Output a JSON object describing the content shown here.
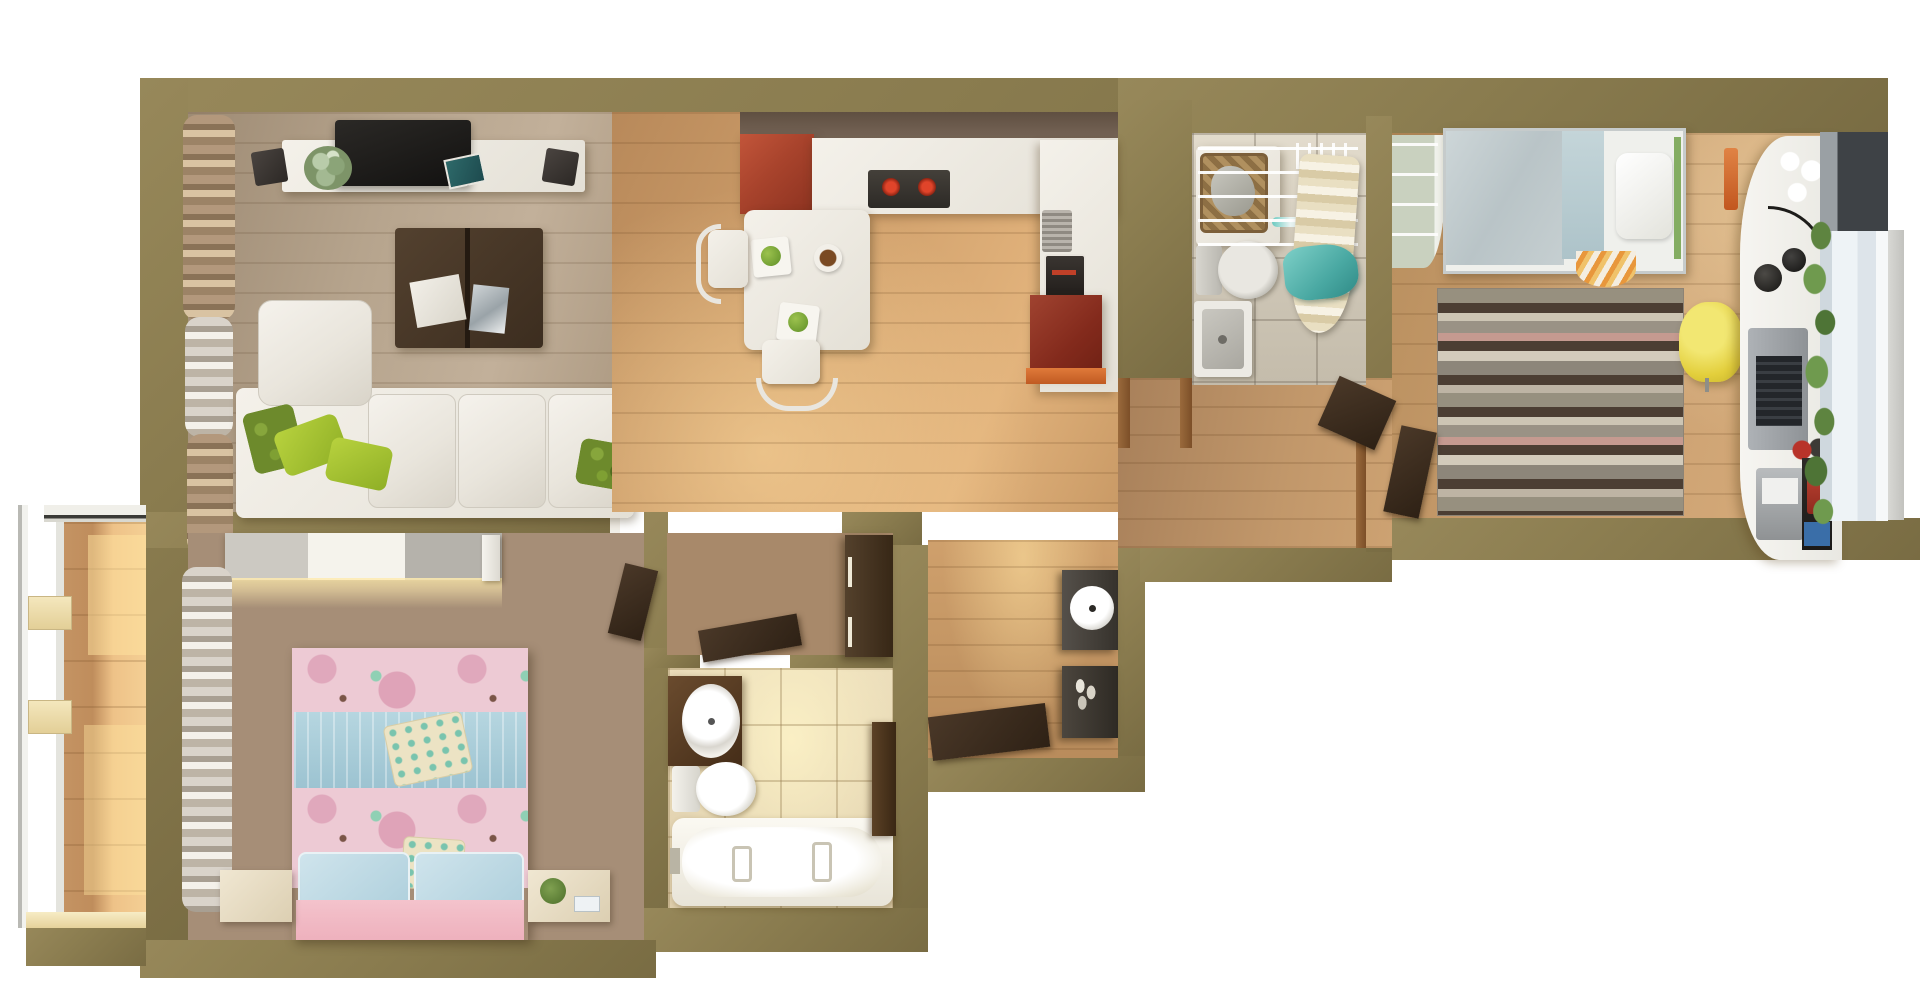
{
  "scene": {
    "type": "3d-floor-plan-render",
    "title": "Top-down 3D render of a two-bedroom apartment floor plan",
    "view": "top-down orthographic",
    "background_color": "#ffffff"
  },
  "palette": {
    "wall_olive": "#8a7c4f",
    "wall_olive_dark": "#796c43",
    "floor_living_wood": "#b3a18c",
    "floor_dining_wood": "#cf9f6b",
    "floor_bedroom_left_wood": "#a68e77",
    "floor_bedroom_right_wood": "#c79d6d",
    "floor_bath_top_tile": "#d2cabb",
    "floor_bath_bottom_tile": "#ecdebd",
    "balcony_wood": "#e2b57c",
    "kitchen_cabinet_red": "#a8432c",
    "kitchen_accent_orange": "#d06a30",
    "sofa_white": "#efece6",
    "pillow_green": "#9ab832",
    "bed_left_pink": "#edcad4",
    "bed_left_blue_band": "#a9ceda",
    "bed_right_grey": "#c3ccce",
    "bed_right_frame_green": "#84ad62",
    "rug_stripe_dark": "#4c3e33",
    "rug_stripe_pink": "#c59a90",
    "chair_yellow": "#e8d84a",
    "towel_teal": "#5cb8ae",
    "door_walnut": "#3c2e20"
  },
  "rooms": {
    "living_room": {
      "name": "Living room",
      "furniture": [
        "window curtains",
        "TV stand",
        "flat TV",
        "two speakers",
        "potted plant",
        "blue book",
        "dark coffee table with magazines",
        "white corner sofa",
        "green decorative pillows"
      ]
    },
    "kitchen_dining": {
      "name": "Kitchen and dining area",
      "furniture": [
        "red glossy cabinet",
        "white L-counter",
        "cooktop with two red burners",
        "oven",
        "dish drainer",
        "red lower cabinet with orange trim",
        "white dining table",
        "two white chairs",
        "plates with green fruit",
        "snack bowl"
      ]
    },
    "bathroom_top": {
      "name": "Bathroom with laundry",
      "furniture": [
        "washing machine",
        "wicker laundry basket",
        "toilet",
        "wash basin",
        "clothes drying rack",
        "hangers",
        "striped ironing board",
        "teal towel"
      ]
    },
    "bedroom_right": {
      "name": "Bedroom right (study)",
      "furniture": [
        "open shelving wardrobe",
        "single bed with grey duvet and white pillow",
        "orange throw",
        "striped rug",
        "yellow desk chair",
        "white wavy desk",
        "laptop",
        "black desk lamp",
        "polka-dot cups",
        "printer",
        "books and phone",
        "monstera plant",
        "window with sheer curtain"
      ]
    },
    "bedroom_left": {
      "name": "Bedroom left (master)",
      "furniture": [
        "sliding-door wardrobe with underlight",
        "double bed with pink floral duvet",
        "blue knitted runner",
        "dotted pillows",
        "two light-blue pillows",
        "two bedside tables",
        "plant and clock",
        "window curtains"
      ]
    },
    "bathroom_bottom": {
      "name": "Bathroom with bathtub",
      "furniture": [
        "dark wood vanity with round basin",
        "toilet",
        "bathtub",
        "tall dark cabinet"
      ]
    },
    "hall_small": {
      "name": "Inner hallway",
      "furniture": [
        "dark wardrobe cabinet",
        "open walnut door"
      ]
    },
    "entry_hall": {
      "name": "Entry hall",
      "furniture": [
        "console with round mirror",
        "shoe cabinet",
        "open entrance door"
      ]
    },
    "corridor": {
      "name": "Corridor",
      "furniture": [
        "wooden door frames",
        "open walnut doors"
      ]
    },
    "balcony": {
      "name": "Glazed balcony",
      "furniture": [
        "window glazing with white frames",
        "sunlit wood floor"
      ]
    }
  }
}
